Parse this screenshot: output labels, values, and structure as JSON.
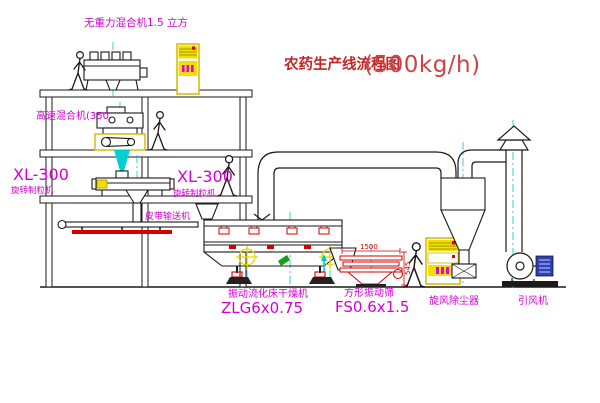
{
  "title": {
    "name": "农药生产线流程图",
    "capacity": "(500kg/h)"
  },
  "equipment_labels": {
    "gravity_mixer": "无重力混合机1.5 立方",
    "high_speed_mixer": "高速混合机(350",
    "granulator_left_model": "XL-300",
    "granulator_left_name": "旋转制粒机",
    "granulator_right_model": "XL-300",
    "granulator_right_name": "旋转制粒机",
    "belt_conveyor": "皮带输送机",
    "fluid_bed_dryer_name": "振动流化床干燥机",
    "fluid_bed_dryer_model": "ZLG6x0.75",
    "square_sieve_name": "方形振动筛",
    "square_sieve_model": "FS0.6x1.5",
    "cyclone": "旋风除尘器",
    "fan": "引风机"
  },
  "dimensions": {
    "sieve_length": "1500",
    "sieve_height": "545"
  },
  "colors": {
    "title_red": "#c22626",
    "label_magenta": "#d400d4",
    "cad_red": "#d40000",
    "cad_yellow": "#f0e000",
    "cad_cyan": "#00c8c8",
    "cad_green": "#16a016",
    "cad_blue": "#2d3fbb",
    "line_black": "#1a1a1a"
  }
}
